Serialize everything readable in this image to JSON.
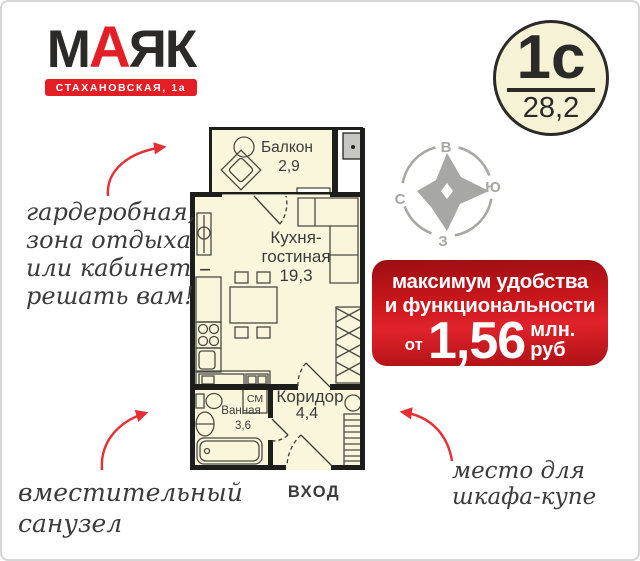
{
  "logo": {
    "m": "М",
    "a": "А",
    "yak": "ЯК",
    "address": "СТАХАНОВСКАЯ, 1а"
  },
  "badge": {
    "type": "1с",
    "area": "28,2"
  },
  "compass": {
    "top": "В",
    "right": "Ю",
    "bottom": "З",
    "left": "С"
  },
  "banner": {
    "line1": "максимум удобства",
    "line2": "и функциональности",
    "from": "от",
    "price": "1,56",
    "unit1": "млн.",
    "unit2": "руб"
  },
  "plan": {
    "rooms": [
      {
        "name": "Балкон",
        "area": "2,9"
      },
      {
        "name_line1": "Кухня-",
        "name_line2": "гостиная",
        "area": "19,3"
      },
      {
        "name": "Ванная",
        "area": "3,6"
      },
      {
        "name": "Коридор",
        "area": "4,4"
      }
    ],
    "washer": "СМ",
    "entrance": "ВХОД"
  },
  "annotations": {
    "wardrobe": [
      "гардеробная,",
      "зона отдыха",
      "или  кабинет –",
      "решать вам!"
    ],
    "bathroom": [
      "вместительный",
      "санузел"
    ],
    "closet": [
      "место для",
      "шкафа-купе"
    ]
  },
  "colors": {
    "brand_red": "#e31e24",
    "banner_red": "#d01920",
    "badge_fill": "#f6f2d5",
    "plan_fill": "#faf6dc",
    "wall": "#1d1d1b",
    "compass_gray": "#a7a7a5"
  }
}
